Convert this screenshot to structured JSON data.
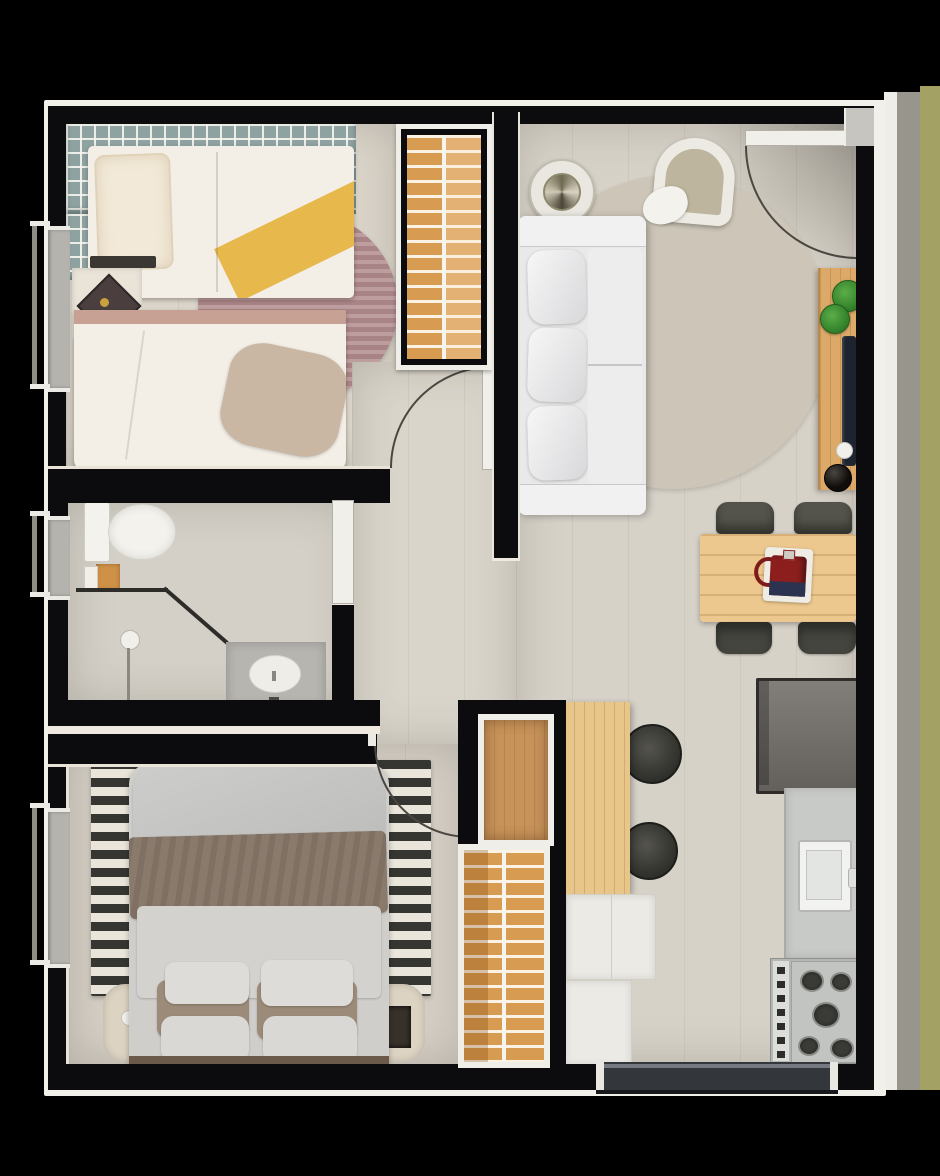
{
  "meta": {
    "title": "apartment-floor-plan",
    "view": "top-down 3d rendered floor plan",
    "has_text": false
  },
  "palette": {
    "background": "#000000",
    "wall": "#0c0c0e",
    "outline": "#f2f0ea",
    "extGray": "#98968c",
    "extOlive": "#a3a164",
    "extWhiteGap": "#efede7",
    "floorLiving": "#d7d2c8",
    "floorHall": "#dad5cb",
    "floorBedroom1": "#dbd5ca",
    "floorBedroom2": "#d5cfc5",
    "floorBathroom": "#d4d0c7",
    "windowGrid": "#8fa2a2",
    "glass": "#b5b3ae",
    "closetWood": "#d89b52",
    "closetWoodLower": "#c8935a",
    "islandWood": "#e8c68a",
    "tableWood": "#ecc88e",
    "deskWood": "#dca968",
    "sofa": "#e9e9ea",
    "rugLiving": "#cdc6b8",
    "rugMauve": "#a98486",
    "rugMauveLight": "#bd9d9e",
    "rugStripeDark": "#353532",
    "rugStripeLight": "#e9e5da",
    "bedWhite": "#f3efe7",
    "yellowThrow": "#e7b84c",
    "beigeThrow": "#c9b6a3",
    "brownBlanket": "#8a7a6b",
    "grayDuvet": "#d3d2cf",
    "fridge": "#716d68",
    "counter": "#c8cac7",
    "stove": "#b5b7b4",
    "balconyTrack": "#33363b",
    "kettleRed": "#8c1f1e",
    "kettleNavy": "#2c3350",
    "showerTray": "#b7b5b0",
    "fixtureWhite": "#f4f2ed",
    "orangeCabinet": "#cf9147"
  },
  "rooms": [
    {
      "id": "bedroom-1",
      "label": "bedroom 1 (top left, two single beds)"
    },
    {
      "id": "wardrobe-1",
      "label": "ladder-shelf wardrobe (top middle)"
    },
    {
      "id": "living-room",
      "label": "living room (top right)"
    },
    {
      "id": "entry",
      "label": "entry (top right corner, door swing)"
    },
    {
      "id": "hallway",
      "label": "hallway (center)"
    },
    {
      "id": "bathroom",
      "label": "bathroom (middle left)"
    },
    {
      "id": "dining-area",
      "label": "dining area (middle right)"
    },
    {
      "id": "kitchen",
      "label": "kitchen (bottom right)"
    },
    {
      "id": "bedroom-2",
      "label": "bedroom 2 (bottom left, double bed)"
    },
    {
      "id": "wardrobe-2",
      "label": "ladder-shelf wardrobe (bottom middle)"
    },
    {
      "id": "balcony-access",
      "label": "sliding door (bottom)"
    }
  ],
  "furniture": [
    "single-bed-with-yellow-throw",
    "guest-bed",
    "round-striped-rug",
    "diamond-side-table",
    "window-radiator-grid",
    "shelf-ladder-wardrobe-top",
    "sofa",
    "spiral-side-table",
    "armchair",
    "round-area-rug",
    "entry-door",
    "desk",
    "potted-plants",
    "laptop",
    "mouse",
    "black-bowl",
    "dining-table",
    "dining-chairs-x4",
    "moka-pot",
    "refrigerator",
    "kitchen-counter",
    "sink",
    "gas-stove",
    "kitchen-island",
    "bar-stools-x2",
    "island-cabinets",
    "shelf-ladder-wardrobe-bottom",
    "double-bed",
    "striped-rug",
    "nightstand-left-with-lamp",
    "nightstand-right-with-tray",
    "toilet",
    "shower-screen",
    "shower-tray",
    "shower-knob",
    "bathroom-door",
    "interior-door-arcs",
    "balcony-sliding-door",
    "left-wall-windows"
  ]
}
